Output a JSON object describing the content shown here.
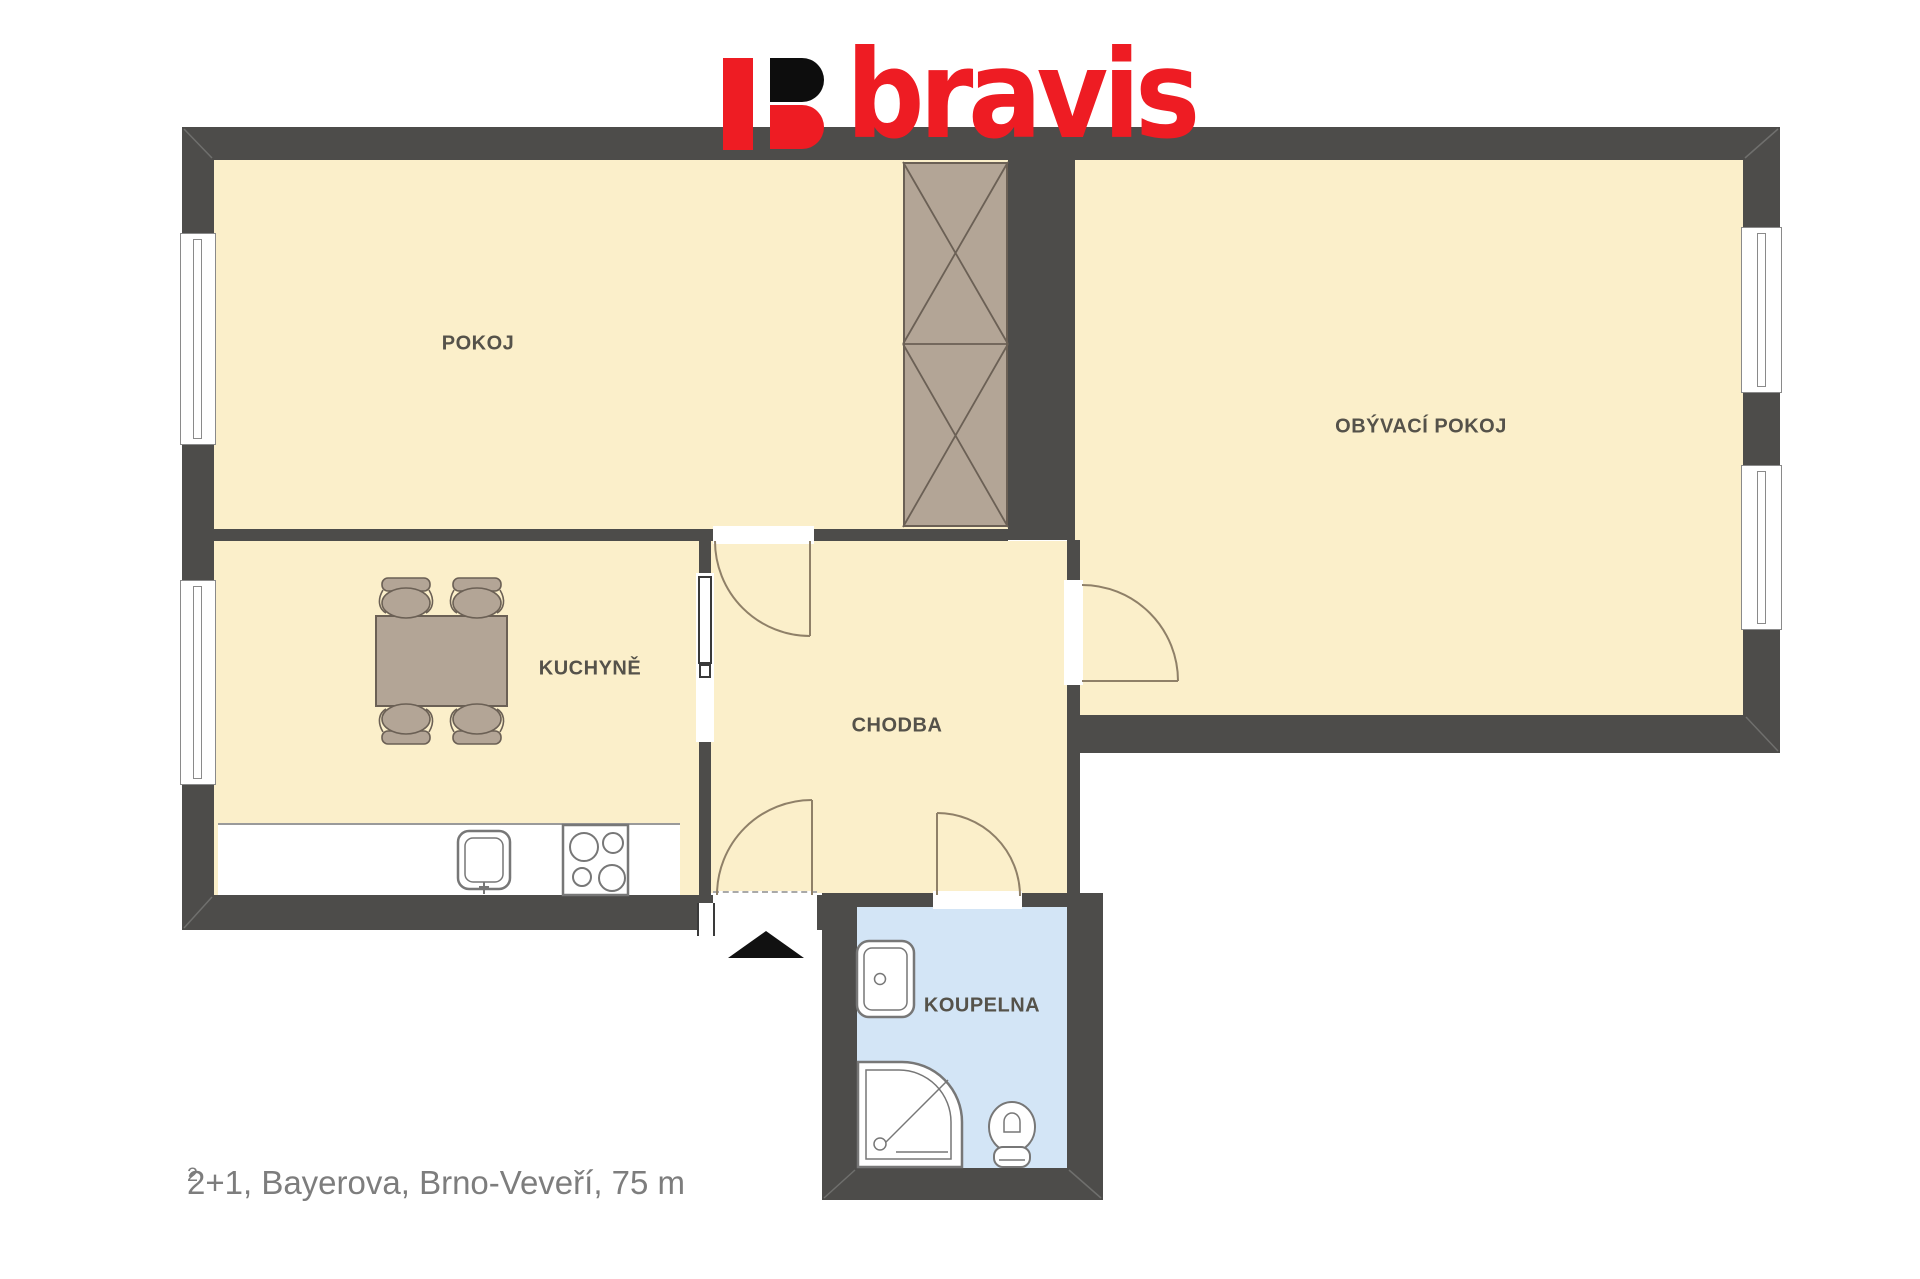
{
  "logo": {
    "letter": "B",
    "text": "bravis",
    "red": "#ee1c23",
    "black": "#0d0d0d"
  },
  "rooms": {
    "pokoj": {
      "label": "POKOJ"
    },
    "obyvaci": {
      "label": "OBÝVACÍ POKOJ"
    },
    "kuchyne": {
      "label": "KUCHYNĚ"
    },
    "chodba": {
      "label": "CHODBA"
    },
    "koupelna": {
      "label": "KOUPELNA"
    }
  },
  "caption": {
    "text": "2+1, Bayerova, Brno-Veveří, 75 m",
    "superscript": "2"
  },
  "palette": {
    "wall": "#4d4c4a",
    "floor": "#fbefca",
    "bath_floor": "#d3e5f6",
    "furniture": "#b3a596",
    "furniture_line": "#6b6055",
    "door_line": "#8f8068",
    "fixture_line": "#777777",
    "label_text": "#55524a",
    "caption_text": "#7d7d7d"
  },
  "fixtures": {
    "wardrobe": "wardrobe",
    "dining_table": "dining-table",
    "chairs": "chair",
    "kitchen_sink": "kitchen-sink",
    "stove": "stove-4-burners",
    "washbasin": "washbasin",
    "shower": "shower-tray",
    "toilet": "toilet",
    "entrance_marker": "entrance-arrow"
  }
}
